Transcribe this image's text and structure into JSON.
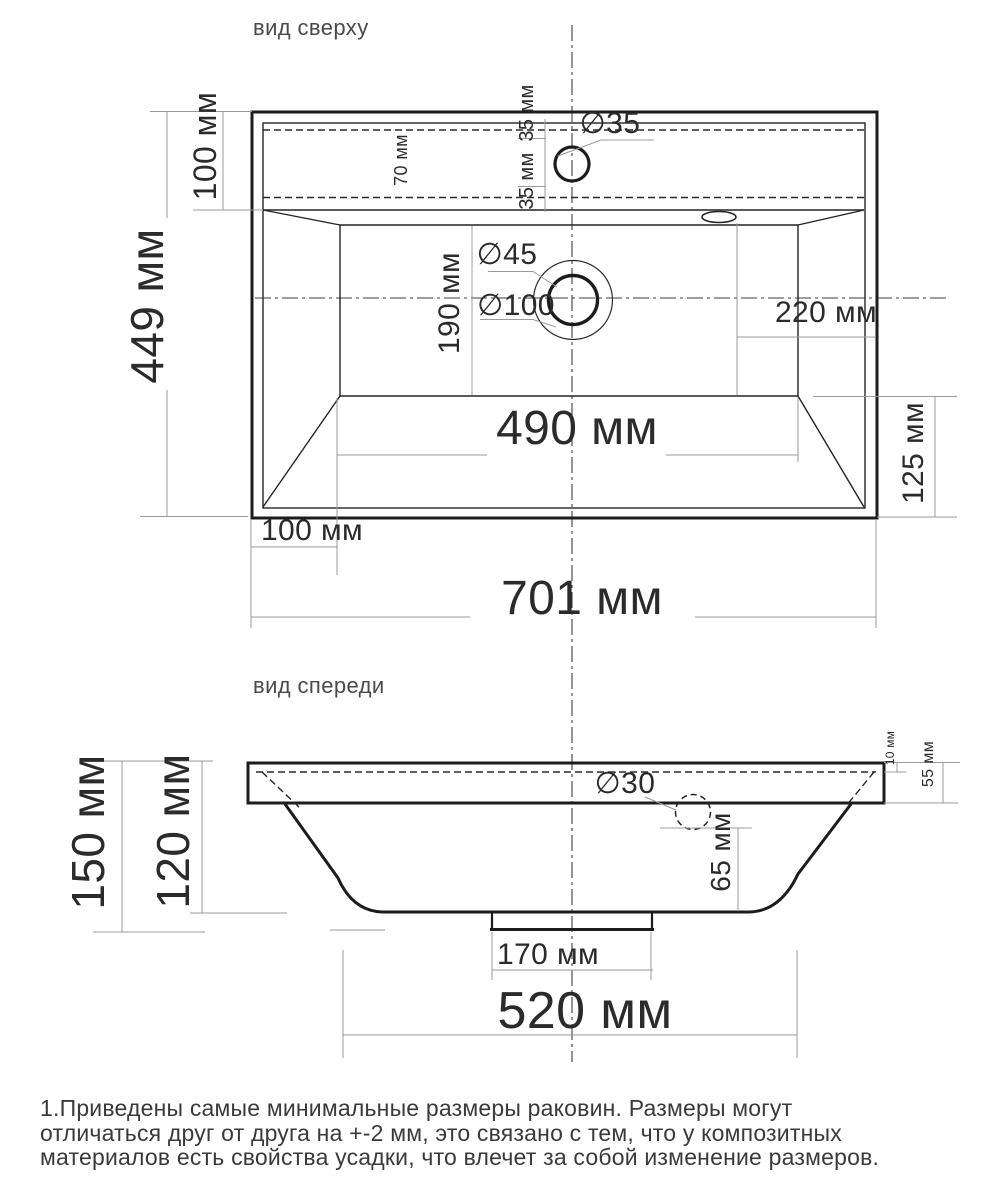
{
  "top_view": {
    "title": "вид сверху",
    "dim_shelf_depth": "100 мм",
    "dim_overall_depth": "449 мм",
    "dim_shelf_inner": "70 мм",
    "dim_faucet_top": "35 мм",
    "dim_faucet_bottom": "35 мм",
    "dia_faucet_hole": "∅35",
    "dia_drain_inner": "∅45",
    "dia_drain_outer": "∅100",
    "dim_basin_depth": "190 мм",
    "dim_overflow_to_edge": "220 мм",
    "dim_basin_width": "490 мм",
    "dim_right_offset": "125 мм",
    "dim_left_offset": "100 мм",
    "dim_overall_width": "701 мм"
  },
  "front_view": {
    "title": "вид спереди",
    "dim_rim_lip": "10 мм",
    "dim_rim_height": "55 мм",
    "dia_overflow_hole": "∅30",
    "dim_overflow_depth": "65 мм",
    "dim_overall_height": "150 мм",
    "dim_body_height": "120 мм",
    "dim_drain_stub_width": "170 мм",
    "dim_bottom_width": "520 мм"
  },
  "note": {
    "line1": "1.Приведены самые минимальные размеры раковин. Размеры могут",
    "line2": "отличаться друг от друга на +-2 мм, это связано с тем, что у композитных",
    "line3": "материалов есть свойства усадки, что влечет за собой изменение размеров."
  },
  "colors": {
    "object_line": "#1c1c1c",
    "dimension_line": "#9b9b9b",
    "text": "#2b2b2b"
  }
}
